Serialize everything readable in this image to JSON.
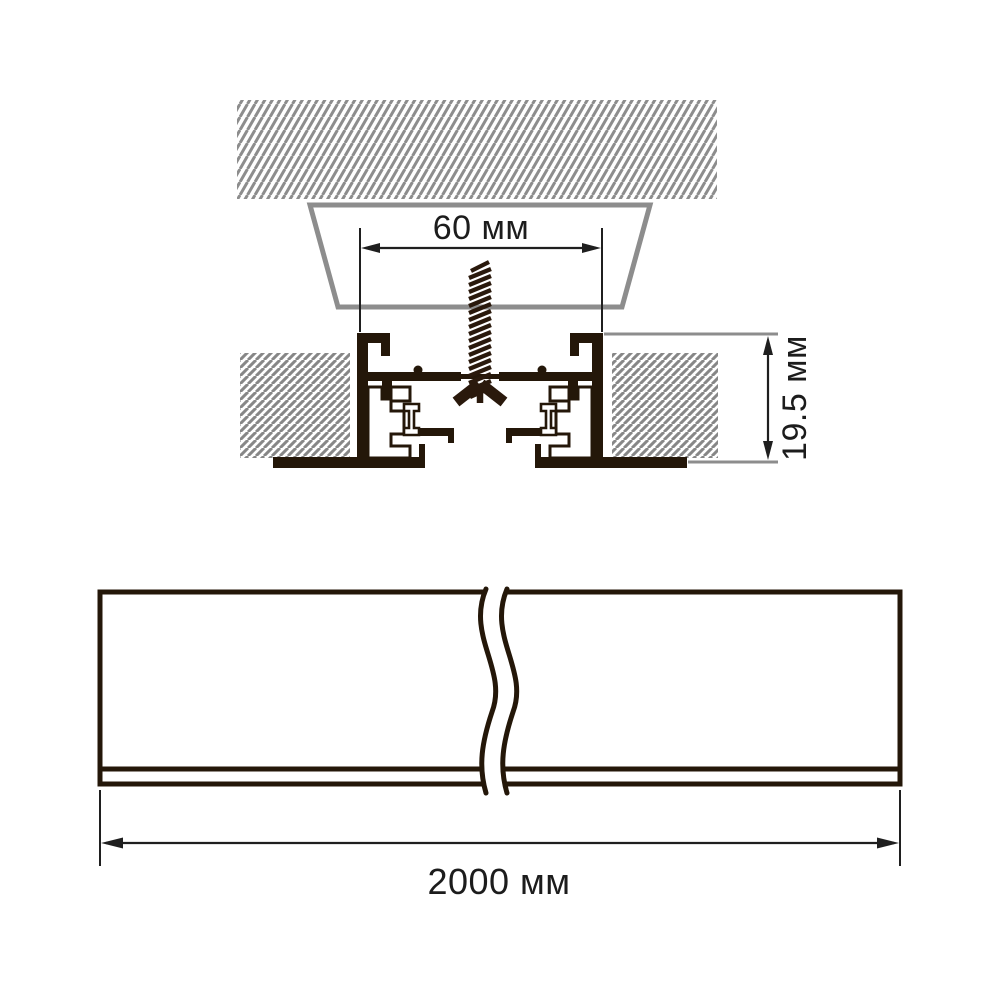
{
  "diagram": {
    "type": "technical-drawing",
    "subject": "recessed-track-profile-mounting",
    "views": {
      "cross_section": {
        "name": "installation cross section",
        "parts": [
          "ceiling-slab-hatched",
          "recess-cutout-trapezoid",
          "mounting-screw",
          "track-profile",
          "ceiling-panels-hatched"
        ]
      },
      "side_view": {
        "name": "profile length view with break symbol"
      }
    },
    "dimensions": [
      {
        "id": "recess-width",
        "label": "60 мм",
        "value": 60,
        "unit": "мм",
        "orientation": "horizontal"
      },
      {
        "id": "profile-height",
        "label": "19.5 мм",
        "value": 19.5,
        "unit": "мм",
        "orientation": "vertical"
      },
      {
        "id": "profile-length",
        "label": "2000 мм",
        "value": 2000,
        "unit": "мм",
        "orientation": "horizontal"
      }
    ],
    "colors": {
      "background": "#ffffff",
      "line_dark": "#241709",
      "screw_dark": "#2a190c",
      "hatch_gray": "#8d8d8d",
      "dimension_line": "#1f1f1f",
      "text": "#1c1c1c"
    }
  }
}
